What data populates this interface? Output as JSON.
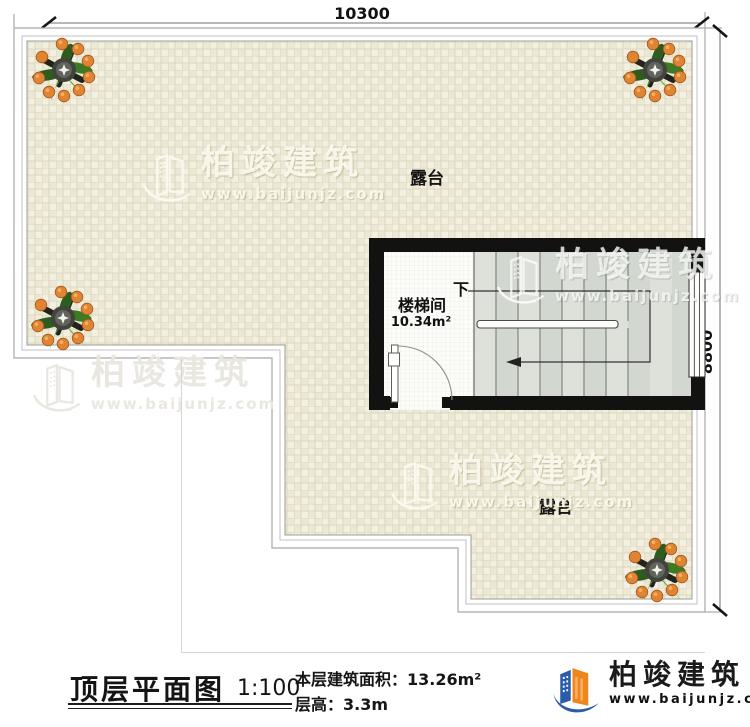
{
  "drawing": {
    "dim_width": "10300",
    "dim_height": "8800",
    "terrace_top_label": "露台",
    "terrace_bottom_label": "露台",
    "stair_room_label": "楼梯间",
    "stair_room_area": "10.34m²",
    "stair_direction_label": "下"
  },
  "watermark": {
    "brand": "柏竣建筑",
    "url": "www.baijunjz.com"
  },
  "title_block": {
    "title": "顶层平面图",
    "scale": "1:100",
    "area_label": "本层建筑面积：",
    "area_value": "13.26m²",
    "floor_height_label": "层高：",
    "floor_height_value": "3.3m"
  },
  "logo": {
    "brand": "柏竣建筑",
    "url": "www.baijunjz.com"
  },
  "colors": {
    "wall_black": "#121210",
    "terrace_beige": "#efecdb",
    "terrace_grid": "#d8d2b8",
    "stair_fill": "#d8ded6",
    "brand_orange": "#f08519",
    "brand_blue": "#2a5caa"
  }
}
